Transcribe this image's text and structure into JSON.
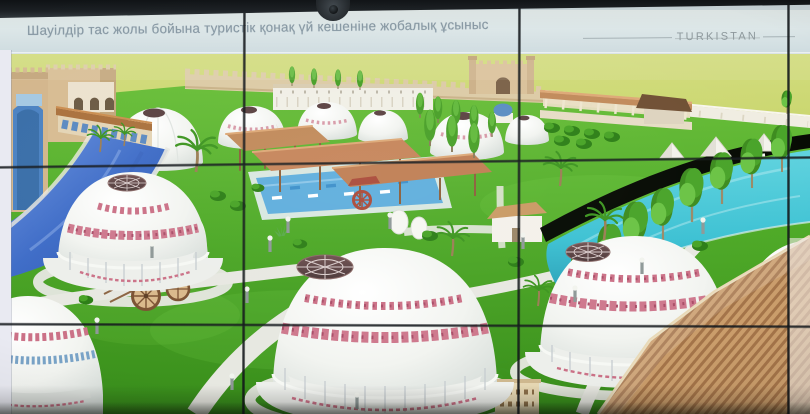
{
  "slide": {
    "title": "Шауілдір тас жолы бойына туристік қонақ үй кешеніне жобалық ұсыныс",
    "brand": "TURKISTAN"
  },
  "palette": {
    "bezel": "#1d2226",
    "band_top": "#e7efee",
    "band_bottom": "#cfdce0",
    "title_text": "#8495a1",
    "brand_text": "#8d989c",
    "seam": "#14181c",
    "field": "#c8d56e",
    "lawn": "#4fa829",
    "path": "#e7e8e1",
    "river": "#3f6cc4",
    "channel": "#3fc0d2",
    "yurt_white": "#f2f4f0",
    "ornament_pink": "#c97287",
    "ornament_blue": "#7aa3c6",
    "dome_cap": "#5a4242",
    "wood": "#c08a5c",
    "wall_beige": "#dccba6",
    "wall_white": "#f0ede2",
    "building_sand": "#d6bc93",
    "portal_blue": "#4c82c0",
    "tree_green": "#4aa22b"
  }
}
